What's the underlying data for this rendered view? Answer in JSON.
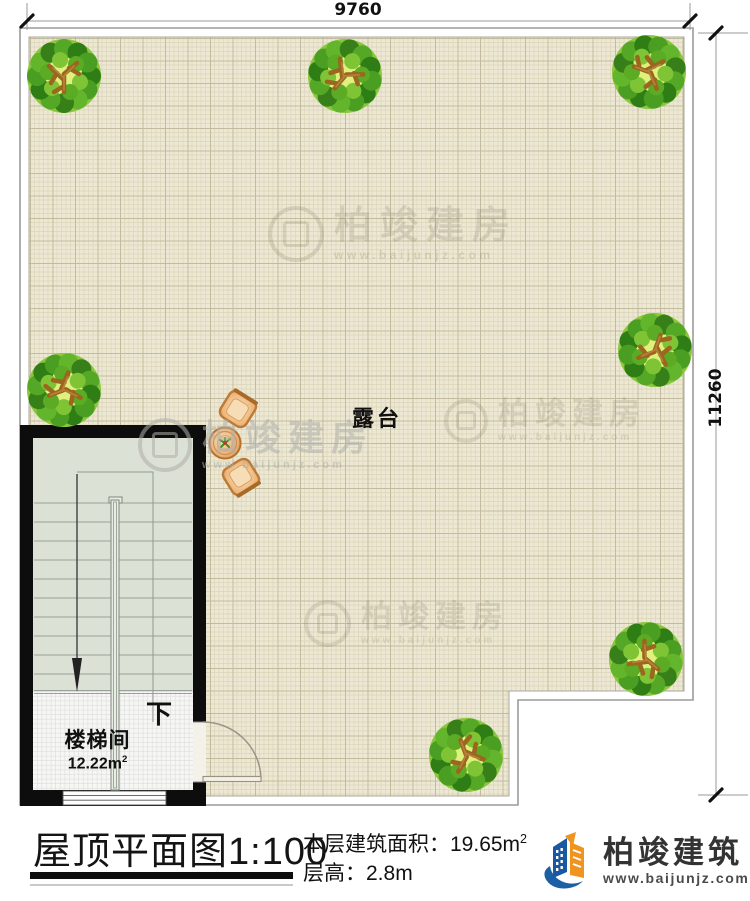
{
  "dimensions": {
    "width_label": "9760",
    "height_label": "11260"
  },
  "plan": {
    "terrace_label": "露台",
    "stair_room_label": "楼梯间",
    "stair_room_area_value": "12.22m",
    "stair_room_area_superscript": "2",
    "stair_down_label": "下"
  },
  "watermark": {
    "brand": "柏竣建房",
    "url": "www.baijunjz.com"
  },
  "title_block": {
    "drawing_title": "屋顶平面图",
    "drawing_scale": "1:100",
    "floor_area_label": "本层建筑面积：",
    "floor_area_value": "19.65m",
    "floor_area_superscript": "2",
    "floor_height_label": "层高：",
    "floor_height_value": "2.8m",
    "brand_name": "柏竣建筑",
    "brand_url": "www.baijunjz.com"
  },
  "colors": {
    "wall": "#0d0d0d",
    "terrace_background": "#ece8d4",
    "stair_background": "#dbe1d5",
    "accent_blue": "#1c5fa5",
    "accent_orange": "#f0941f",
    "tree_green": "#4a9e22",
    "furniture_tan": "#e7a866"
  }
}
